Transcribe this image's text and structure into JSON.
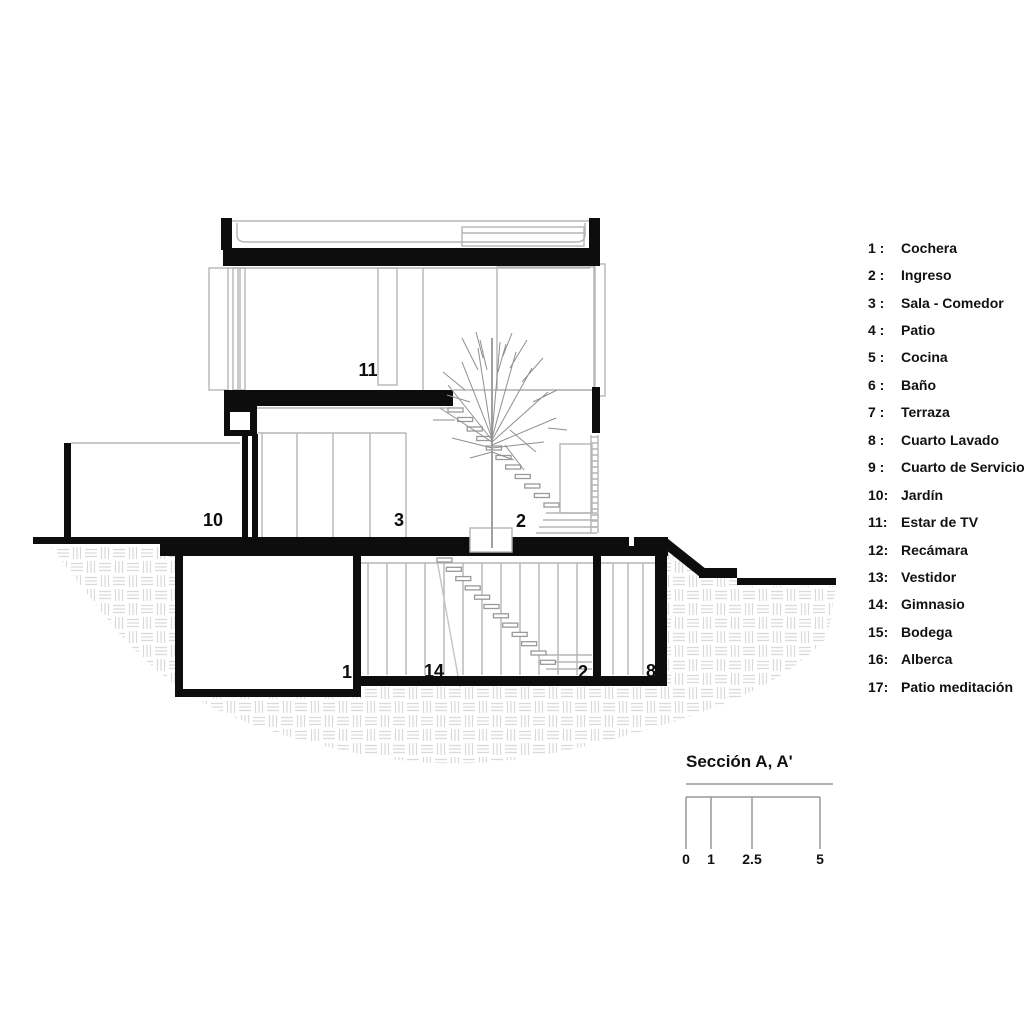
{
  "legend": {
    "items": [
      {
        "num": "1 :",
        "name": "Cochera"
      },
      {
        "num": "2 :",
        "name": "Ingreso"
      },
      {
        "num": "3 :",
        "name": "Sala - Comedor"
      },
      {
        "num": "4 :",
        "name": "Patio"
      },
      {
        "num": "5 :",
        "name": "Cocina"
      },
      {
        "num": "6 :",
        "name": "Baño"
      },
      {
        "num": "7 :",
        "name": "Terraza"
      },
      {
        "num": "8 :",
        "name": "Cuarto Lavado"
      },
      {
        "num": "9 :",
        "name": "Cuarto de Servicio"
      },
      {
        "num": "10:",
        "name": "Jardín"
      },
      {
        "num": "11:",
        "name": "Estar de TV"
      },
      {
        "num": "12:",
        "name": "Recámara"
      },
      {
        "num": "13:",
        "name": "Vestidor"
      },
      {
        "num": "14:",
        "name": "Gimnasio"
      },
      {
        "num": "15:",
        "name": "Bodega"
      },
      {
        "num": "16:",
        "name": "Alberca"
      },
      {
        "num": "17:",
        "name": "Patio meditación"
      }
    ]
  },
  "drawing": {
    "room_labels": [
      {
        "room": "estar-de-tv",
        "text": "11"
      },
      {
        "room": "jardin",
        "text": "10"
      },
      {
        "room": "sala-comedor",
        "text": "3"
      },
      {
        "room": "ingreso-ground",
        "text": "2"
      },
      {
        "room": "cochera",
        "text": "1"
      },
      {
        "room": "gimnasio",
        "text": "14"
      },
      {
        "room": "ingreso-basement",
        "text": "2"
      },
      {
        "room": "cuarto-lavado",
        "text": "8"
      }
    ]
  },
  "scalebar": {
    "title": "Sección A, A'",
    "ticks": [
      "0",
      "1",
      "2.5",
      "5"
    ]
  },
  "colors": {
    "ink": "#0d0d0d",
    "outline": "#b5b5b5",
    "hatch": "#d9d9d9",
    "background": "#ffffff"
  }
}
